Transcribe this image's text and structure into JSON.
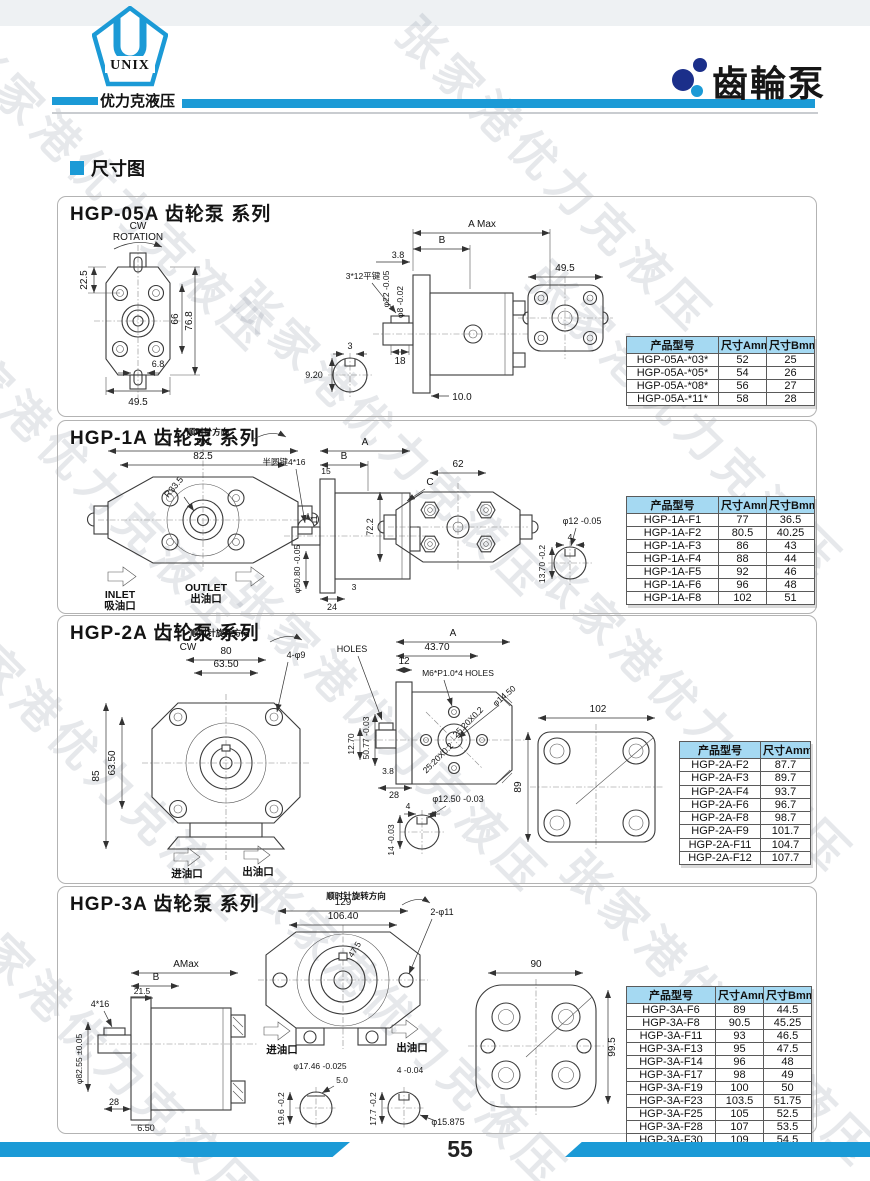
{
  "header": {
    "logo_text": "UNIX",
    "logo_caption": "优力克液压",
    "title": "齒輪泵"
  },
  "section_heading": "尺寸图",
  "watermark": "张家港优力克液压",
  "page": {
    "number": "55"
  },
  "colors": {
    "accent": "#1b9ad6",
    "table_header_bg": "#a5d9f2",
    "dot_dark": "#1b2f8a"
  },
  "sections": [
    {
      "title": "HGP-05A 齿轮泵 系列",
      "labels": {
        "cw": "CW",
        "rotation": "ROTATION",
        "h225": "22.5",
        "h66": "66",
        "h768": "76.8",
        "h68": "6.8",
        "w495": "49.5",
        "amax": "A Max",
        "b": "B",
        "n38": "3.8",
        "d22": "φ22 -0.05",
        "d8": "φ8 -0.02",
        "key": "3*12平键",
        "n18": "18",
        "n100": "10.0",
        "n3": "3",
        "n920": "9.20",
        "w495r": "49.5"
      },
      "table": {
        "headers": [
          "产品型号",
          "尺寸Amm",
          "尺寸Bmm"
        ],
        "rows": [
          [
            "HGP-05A-*03*",
            "52",
            "25"
          ],
          [
            "HGP-05A-*05*",
            "54",
            "26"
          ],
          [
            "HGP-05A-*08*",
            "56",
            "27"
          ],
          [
            "HGP-05A-*11*",
            "58",
            "28"
          ]
        ]
      }
    },
    {
      "title": "HGP-1A 齿轮泵 系列",
      "labels": {
        "rot": "顺时针方向",
        "n101": "101",
        "n825": "82.5",
        "r335": "R33.5",
        "n11": "11",
        "inlet_en": "INLET",
        "inlet_cn": "吸油口",
        "outlet_en": "OUTLET",
        "outlet_cn": "出油口",
        "a": "A",
        "b": "B",
        "n15": "15",
        "halfkey": "半圆键4*16",
        "d5080": "φ50.80 -0.05",
        "n24": "24",
        "n3": "3",
        "c": "C",
        "n62": "62",
        "n722": "72.2",
        "d12": "φ12 -0.05",
        "n4": "4",
        "n1370": "13.70 -0.2"
      },
      "table": {
        "headers": [
          "产品型号",
          "尺寸Amm",
          "尺寸Bmm"
        ],
        "rows": [
          [
            "HGP-1A-F1",
            "77",
            "36.5"
          ],
          [
            "HGP-1A-F2",
            "80.5",
            "40.25"
          ],
          [
            "HGP-1A-F3",
            "86",
            "43"
          ],
          [
            "HGP-1A-F4",
            "88",
            "44"
          ],
          [
            "HGP-1A-F5",
            "92",
            "46"
          ],
          [
            "HGP-1A-F6",
            "96",
            "48"
          ],
          [
            "HGP-1A-F8",
            "102",
            "51"
          ]
        ]
      }
    },
    {
      "title": "HGP-2A 齿轮泵 系列",
      "labels": {
        "rot": "顺时针旋转方向",
        "cw": "CW",
        "n80": "80",
        "n6350t": "63.50",
        "holes4": "4-φ9",
        "n85": "85",
        "n6350l": "63.50",
        "inlet": "进油口",
        "outlet": "出油口",
        "holes": "HOLES",
        "a": "A",
        "n4370": "43.70",
        "n12": "12",
        "m6": "M6*P1.0*4 HOLES",
        "d1450": "φ14.50",
        "n2520a": "25.20X0.2",
        "n2520b": "25.20X0.2",
        "d5077": "50.77 -0.03",
        "n1270": "12.70",
        "n38": "3.8",
        "n28": "28",
        "d1250": "φ12.50 -0.03",
        "n4": "4",
        "n14": "14 -0.03",
        "n102": "102",
        "n89": "89"
      },
      "table": {
        "headers": [
          "产品型号",
          "尺寸Amm"
        ],
        "rows": [
          [
            "HGP-2A-F2",
            "87.7"
          ],
          [
            "HGP-2A-F3",
            "89.7"
          ],
          [
            "HGP-2A-F4",
            "93.7"
          ],
          [
            "HGP-2A-F6",
            "96.7"
          ],
          [
            "HGP-2A-F8",
            "98.7"
          ],
          [
            "HGP-2A-F9",
            "101.7"
          ],
          [
            "HGP-2A-F11",
            "104.7"
          ],
          [
            "HGP-2A-F12",
            "107.7"
          ]
        ]
      }
    },
    {
      "title": "HGP-3A 齿轮泵 系列",
      "labels": {
        "amax": "AMax",
        "b": "B",
        "n215": "21.5",
        "key": "4*16",
        "d8255": "φ82.55 ±0.05",
        "n28": "28",
        "n650": "6.50",
        "rot": "顺时针旋转方向",
        "n129": "129",
        "n10640": "106.40",
        "n475": "47.5",
        "holes2": "2-φ11",
        "inlet": "进油口",
        "outlet": "出油口",
        "d1746": "φ17.46 -0.025",
        "n50": "5.0",
        "n196": "19.6 -0.2",
        "n4": "4 -0.04",
        "n177": "17.7 -0.2",
        "d15875": "φ15.875",
        "n90": "90",
        "n995": "99.5"
      },
      "table": {
        "headers": [
          "产品型号",
          "尺寸Amm",
          "尺寸Bmm"
        ],
        "rows": [
          [
            "HGP-3A-F6",
            "89",
            "44.5"
          ],
          [
            "HGP-3A-F8",
            "90.5",
            "45.25"
          ],
          [
            "HGP-3A-F11",
            "93",
            "46.5"
          ],
          [
            "HGP-3A-F13",
            "95",
            "47.5"
          ],
          [
            "HGP-3A-F14",
            "96",
            "48"
          ],
          [
            "HGP-3A-F17",
            "98",
            "49"
          ],
          [
            "HGP-3A-F19",
            "100",
            "50"
          ],
          [
            "HGP-3A-F23",
            "103.5",
            "51.75"
          ],
          [
            "HGP-3A-F25",
            "105",
            "52.5"
          ],
          [
            "HGP-3A-F28",
            "107",
            "53.5"
          ],
          [
            "HGP-3A-F30",
            "109",
            "54.5"
          ]
        ]
      }
    }
  ]
}
